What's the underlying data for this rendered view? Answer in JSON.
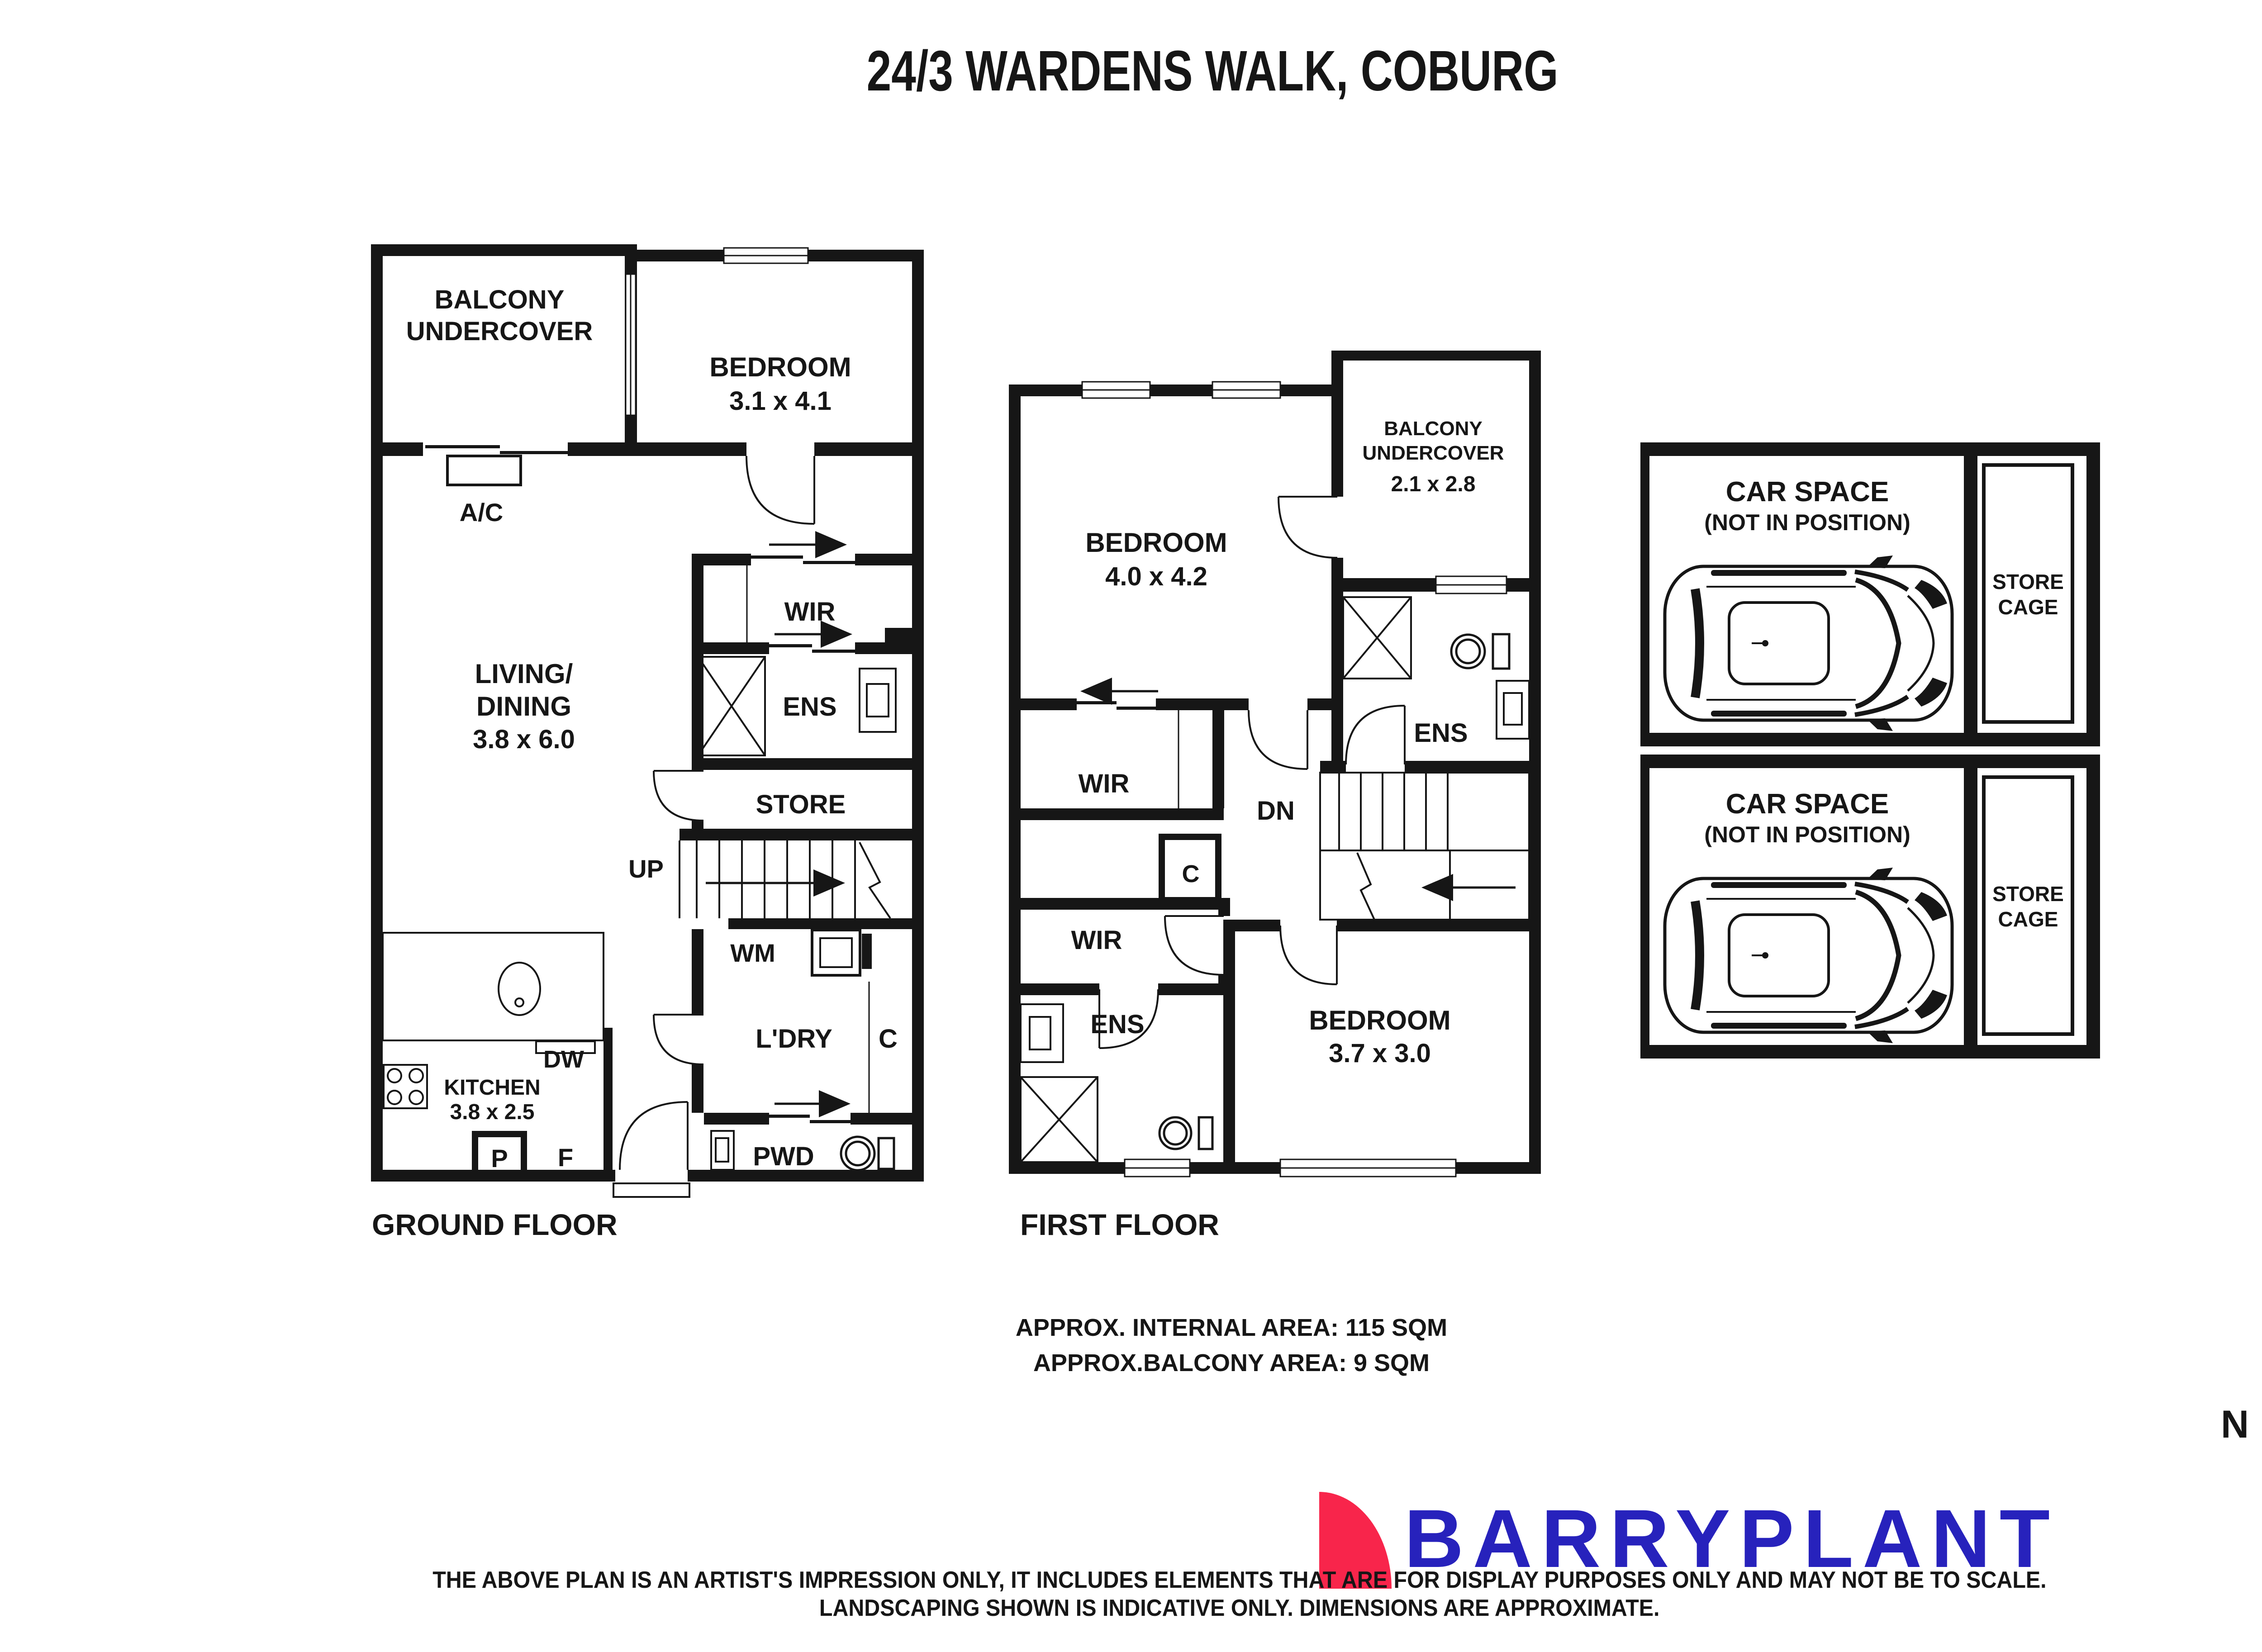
{
  "title": "24/3 WARDENS WALK, COBURG",
  "gf": {
    "name": "GROUND FLOOR",
    "balcony1": "BALCONY",
    "balcony2": "UNDERCOVER",
    "ac": "A/C",
    "bedroom": "BEDROOM",
    "bedroom_dims": "3.1 x 4.1",
    "wir": "WIR",
    "ens": "ENS",
    "living1": "LIVING/",
    "living2": "DINING",
    "living_dims": "3.8 x 6.0",
    "store": "STORE",
    "up": "UP",
    "wm": "WM",
    "ldry": "L'DRY",
    "c": "C",
    "kitchen": "KITCHEN",
    "kitchen_dims": "3.8 x 2.5",
    "dw": "DW",
    "p": "P",
    "f": "F",
    "pwd": "PWD"
  },
  "ff": {
    "name": "FIRST FLOOR",
    "bedroom2": "BEDROOM",
    "bedroom2_dims": "4.0 x 4.2",
    "balcony1": "BALCONY",
    "balcony2": "UNDERCOVER",
    "balcony_dims": "2.1 x 2.8",
    "ens": "ENS",
    "wir": "WIR",
    "dn": "DN",
    "c": "C",
    "bedroom3": "BEDROOM",
    "bedroom3_dims": "3.7 x 3.0"
  },
  "car": {
    "space1": "CAR SPACE",
    "space2": "(NOT IN POSITION)",
    "cage1": "STORE",
    "cage2": "CAGE"
  },
  "areas": {
    "internal": "APPROX. INTERNAL AREA: 115 SQM",
    "balcony": "APPROX.BALCONY AREA: 9 SQM"
  },
  "compass": {
    "north": "N"
  },
  "brand": {
    "logo_text": "BARRYPLANT",
    "logo_blue": "#2722BC",
    "logo_pink": "#F8254B"
  },
  "disc": {
    "line1": "THE ABOVE PLAN IS AN ARTIST'S IMPRESSION ONLY, IT INCLUDES ELEMENTS THAT ARE FOR DISPLAY PURPOSES ONLY AND MAY NOT BE TO SCALE.",
    "line2": "LANDSCAPING SHOWN IS INDICATIVE ONLY. DIMENSIONS ARE APPROXIMATE."
  }
}
